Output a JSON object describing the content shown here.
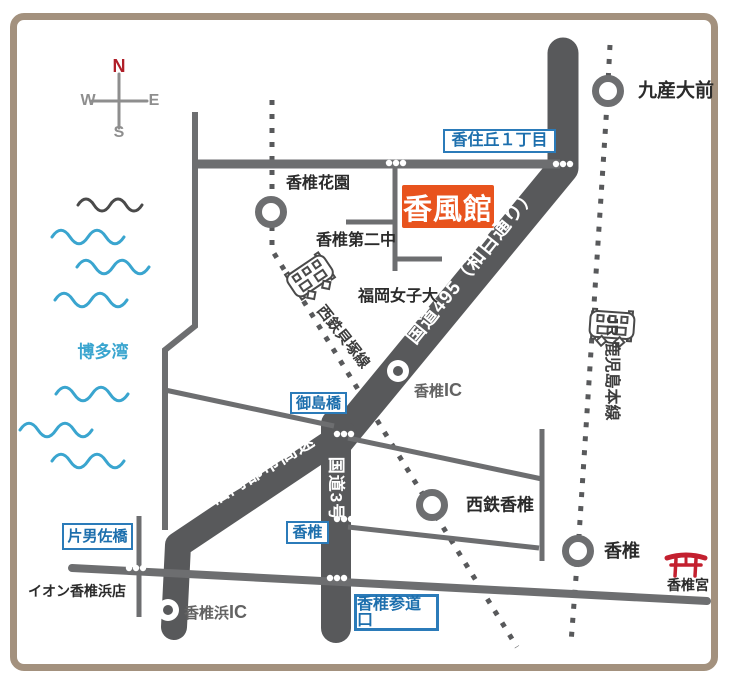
{
  "destination": {
    "name": "香風館"
  },
  "compass": {
    "north": "N",
    "west": "W",
    "east": "E",
    "south": "S"
  },
  "sea": {
    "name": "博多湾"
  },
  "roads": {
    "route495": "国道495（和白通り）",
    "route3": "国道3号",
    "expressway": "福岡都市高速"
  },
  "railways": {
    "kaizuka_line": "西鉄貝塚線",
    "jr_line": "JR 鹿児島本線"
  },
  "stations": {
    "kashiikaen": "香椎花園",
    "kyusandaimae": "九産大前",
    "nishitetsu_kashii": "西鉄香椎",
    "kashii_jr": "香椎"
  },
  "intersections": {
    "kasumigaoka": "香住丘１丁目",
    "mishimabashi": "御島橋",
    "kashii": "香椎",
    "kataozabashi": "片男佐橋",
    "sandoguchi": "香椎参道口"
  },
  "landmarks": {
    "kashii_daini": "香椎第二中",
    "fukuoka_joshidai": "福岡女子大",
    "aeon_kashiihama": "イオン香椎浜店",
    "kashiigu": "香椎宮"
  },
  "ics": {
    "kashii_ic": {
      "name": "香椎",
      "suffix": "IC"
    },
    "kashiihama_ic": {
      "name": "香椎浜",
      "suffix": "IC"
    }
  },
  "colors": {
    "road": "#58595b",
    "road_thin": "#6d6e70",
    "label_blue": "#1d6fad",
    "box_border_blue": "#2b7bb9",
    "destination_orange": "#e8531d",
    "wave_blue": "#3aa5cf",
    "torii_red": "#c3202f",
    "north_red": "#b01e28",
    "frame_tan": "#a3917e"
  }
}
